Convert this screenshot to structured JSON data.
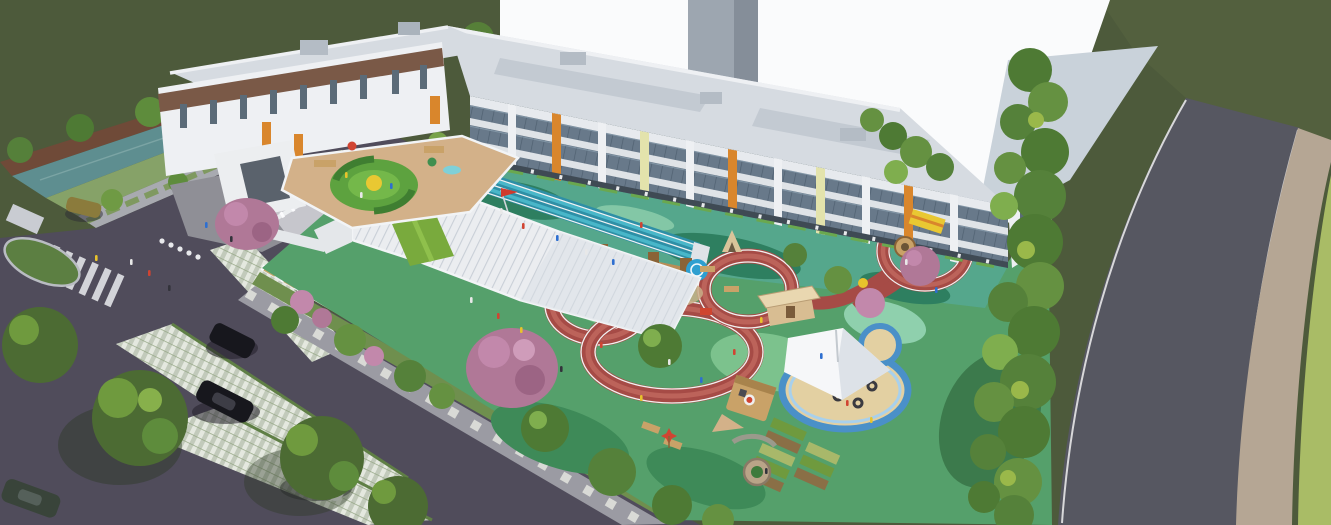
{
  "scene": {
    "type": "aerial-architectural-rendering",
    "subject": "kindergarten campus bird's-eye view with U-shaped school building, rooftop play terrace, grand staircase, looping red running track playground, sand pit with tensile canopy, parking lot and perimeter roads"
  },
  "palette": {
    "field_dark": "#4d5a3b",
    "field_right": "#53603e",
    "corner_grass": "#a9bc66",
    "water": "#5e8e90",
    "bank": "#86a268",
    "wall_brown": "#6f4a38",
    "sky_white": "#fafbfc",
    "plaza": "#c9d2da",
    "tower_gray": "#9da6b0",
    "road": "#565761",
    "sidewalk_tan": "#b5a694",
    "asphalt": "#504c5b",
    "verge_green": "#6f8f4e",
    "sidewalk_gray": "#9b9ba3",
    "fence_white": "#eceef0",
    "fence_tan": "#c9a96b",
    "bldg_white": "#eef0f3",
    "bldg_roof": "#d6dbe1",
    "bldg_roof_dark": "#c3cad2",
    "glass": "#68798a",
    "band_brown": "#7a5947",
    "accent_orange": "#d9862c",
    "accent_yellow": "#e3e3ac",
    "wall_green": "#a9b969",
    "court_teal": "#55a78c",
    "court_dark": "#2e7f60",
    "court_mint": "#8fd0ad",
    "lane_blue": "#2e8fa6",
    "lane_blue_light": "#49b7c9",
    "deck_tan": "#d3b189",
    "maze_green": "#5da23f",
    "maze_yellow": "#e9c832",
    "stairs_white": "#ebedf0",
    "lawn_green": "#79aa3d",
    "play_green": "#55a06b",
    "play_light": "#7cc28d",
    "play_dark": "#3e8a58",
    "track_red": "#a64b46",
    "track_red_light": "#c0675e",
    "track_line": "#f2f2f2",
    "sand": "#e3d0a2",
    "stream_blue": "#4a90c8",
    "stream_light": "#a8d0ec",
    "canopy_white": "#f6f7f9",
    "wood": "#b98d56",
    "wood_dark": "#8a6336",
    "tree_green": "#4e7a34",
    "tree_mid": "#659141",
    "tree_light": "#7fae4e",
    "tree_pink": "#c288ab",
    "flag_red": "#d03a2e",
    "slide_blue": "#2e9fd0",
    "slide_red": "#d04432",
    "car_black": "#17171d",
    "car_white": "#e9eaec",
    "car_olive": "#8b7b3c",
    "car_green": "#39443a"
  }
}
